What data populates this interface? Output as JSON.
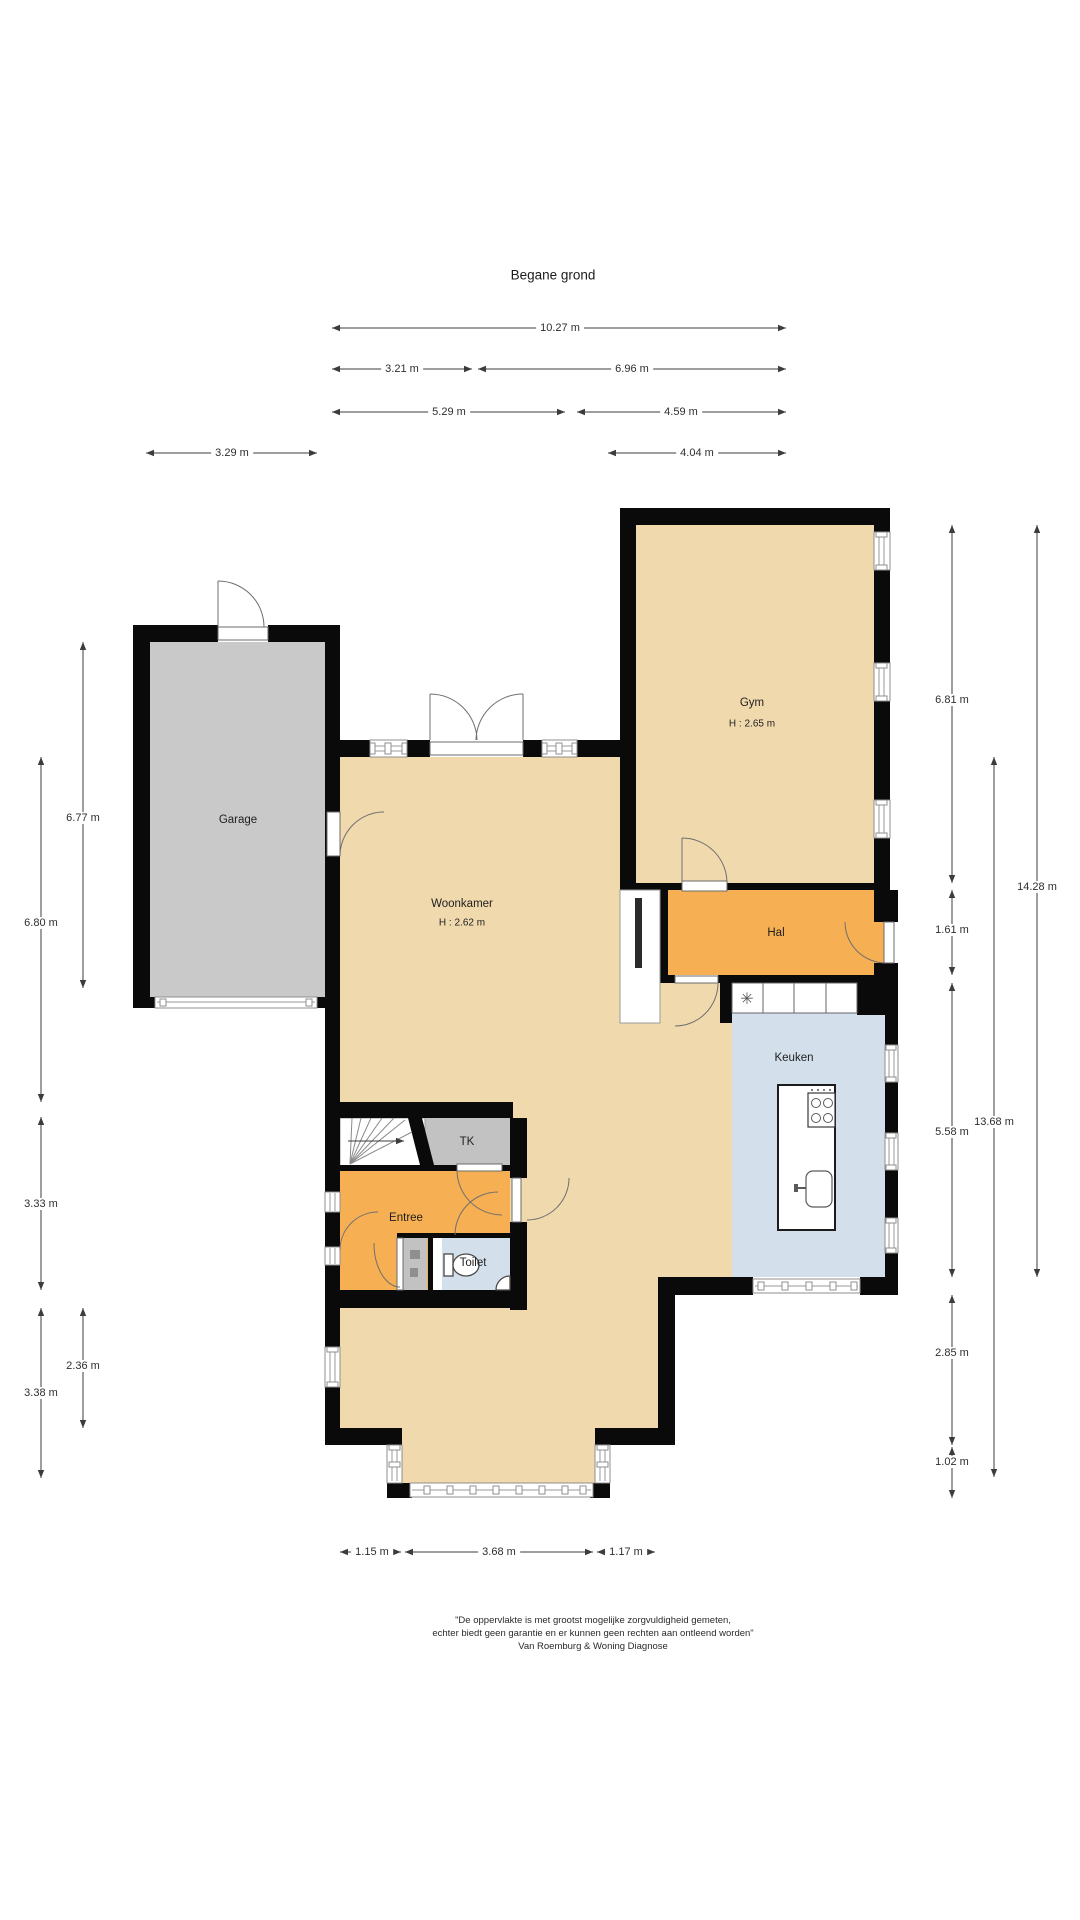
{
  "title": "Begane grond",
  "floor": {
    "rooms": [
      {
        "id": "garage",
        "label": "Garage"
      },
      {
        "id": "gym",
        "label": "Gym",
        "height": "H : 2.65 m"
      },
      {
        "id": "woonkamer",
        "label": "Woonkamer",
        "height": "H : 2.62 m"
      },
      {
        "id": "hal",
        "label": "Hal"
      },
      {
        "id": "keuken",
        "label": "Keuken"
      },
      {
        "id": "tk",
        "label": "TK"
      },
      {
        "id": "entree",
        "label": "Entree"
      },
      {
        "id": "toilet",
        "label": "Toilet"
      }
    ]
  },
  "dims": {
    "w_total": "10.27 m",
    "w_left": "3.21 m",
    "w_right": "6.96 m",
    "w_woon": "5.29 m",
    "w_gym": "4.59 m",
    "w_garage": "3.29 m",
    "w_hal": "4.04 m",
    "h_garage": "6.77 m",
    "h_woon_left": "6.80 m",
    "h_entree": "3.33 m",
    "h_bottom_left": "3.38 m",
    "h_bay_left": "2.36 m",
    "h_gym": "6.81 m",
    "h_hal": "1.61 m",
    "h_keuken": "5.58 m",
    "h_lower_right": "2.85 m",
    "h_bay_right": "1.02 m",
    "h_right_inner": "13.68 m",
    "h_right_total": "14.28 m",
    "b_left": "1.15 m",
    "b_mid": "3.68 m",
    "b_right": "1.17 m"
  },
  "fixtures": {
    "boiler_symbol": "✳"
  },
  "disclaimer": {
    "line1": "\"De oppervlakte is met grootst mogelijke zorgvuldigheid gemeten,",
    "line2": "echter biedt geen garantie en er kunnen geen rechten aan ontleend worden\"",
    "line3": "Van Roemburg & Woning Diagnose"
  },
  "colors": {
    "wall": "#0a0a0a",
    "living": "#f0d9ad",
    "hall_orange": "#f6b053",
    "garage_gray": "#c9c9c9",
    "kitchen_blue": "#d3e0ec",
    "closet_gray": "#c2c2c2"
  }
}
